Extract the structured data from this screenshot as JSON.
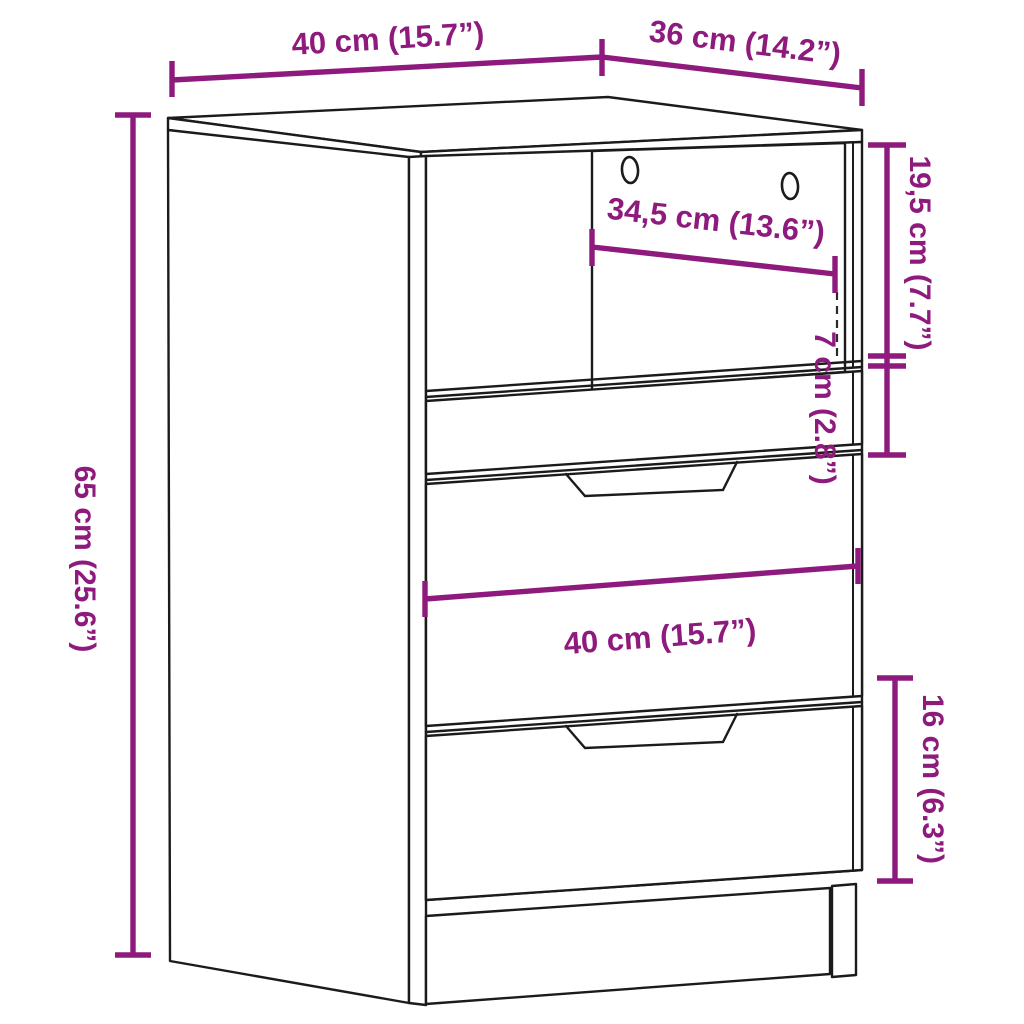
{
  "diagram": {
    "title": "Furniture dimension diagram",
    "product": "Bedside cabinet with open shelf and three drawers",
    "style": {
      "dimension_color": "#8E1A7D",
      "outline_color": "#1b1b1b",
      "background_color": "#ffffff"
    }
  },
  "labels": {
    "top_width": "40 cm (15.7”)",
    "top_depth": "36 cm (14.2”)",
    "inner_shelf_width": "34,5 cm (13.6”)",
    "shelf_opening_height": "19,5 cm (7.7”)",
    "small_drawer_height": "7 cm (2.8”)",
    "total_height": "65 cm (25.6”)",
    "drawer_front_width": "40 cm (15.7”)",
    "bottom_drawer_height": "16 cm (6.3”)"
  }
}
